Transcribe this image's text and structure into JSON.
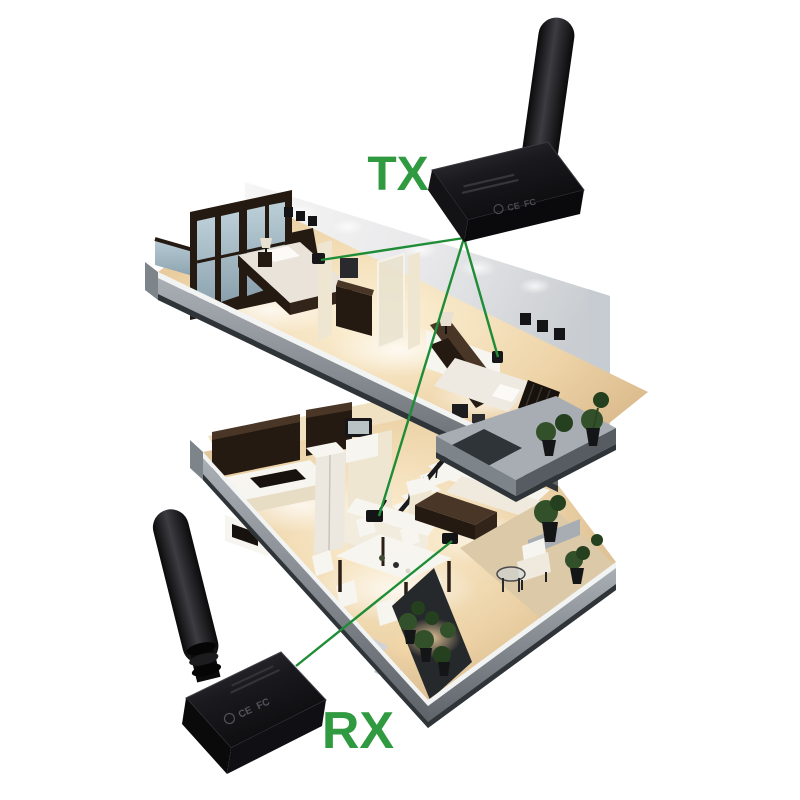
{
  "page": {
    "background": "#ffffff",
    "description": "Wireless transmitter and receiver shown with cutaway two-story house and green signal paths"
  },
  "labels": {
    "tx": "TX",
    "rx": "RX"
  },
  "colors": {
    "accent_green": "#2f9a40",
    "signal_line_green": "#1f8c36",
    "device_black": "#141416",
    "slab_gray": "#8f969c",
    "floor_warm": "#ecd6b0",
    "wall_white": "#f0f0f1"
  },
  "devices": {
    "transmitter": {
      "label": "TX",
      "marks": [
        "CE",
        "FC"
      ]
    },
    "receiver": {
      "label": "RX",
      "marks": [
        "CE",
        "FC"
      ]
    }
  },
  "scene": {
    "floors": [
      {
        "name": "upper floor",
        "rooms": [
          "bedroom",
          "bathroom",
          "bedroom",
          "terrace"
        ]
      },
      {
        "name": "lower floor",
        "rooms": [
          "kitchen",
          "dining area",
          "living room",
          "balcony",
          "garden"
        ]
      }
    ],
    "signal_links": [
      {
        "from": "transmitter",
        "to": "bedroom-left wall device"
      },
      {
        "from": "transmitter",
        "to": "bedroom-right wall device"
      },
      {
        "from": "transmitter",
        "to": "lower-floor counter device"
      },
      {
        "from": "living-room device",
        "to": "receiver"
      }
    ]
  }
}
